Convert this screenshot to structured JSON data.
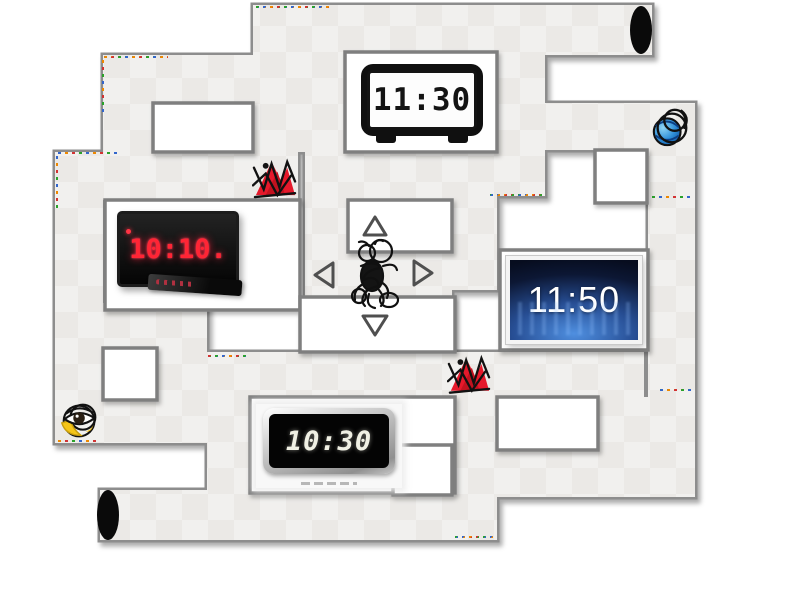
{
  "maze": {
    "wall_color": "#8d8d8d",
    "path_color": "#f1f0ee",
    "path_alt_color": "#ebe9e6",
    "room_color": "#ffffff",
    "tunnel_color": "#0a0a0a",
    "tunnels": [
      "top-right-opening",
      "bottom-left-opening"
    ]
  },
  "clocks": {
    "alarm": {
      "time": "11:30",
      "kind": "black digital alarm clock",
      "digit_color": "#141414",
      "face_color": "#fdfdfd"
    },
    "led": {
      "time": "10:10.",
      "kind": "red LED wall clock with remote",
      "digit_color": "#ff2535",
      "face_color": "#0a0a0a"
    },
    "screen": {
      "time": "11:50",
      "kind": "glowing blue screen clock",
      "digit_color": "#ffffff",
      "face_color": "#16305e"
    },
    "wall": {
      "time": "10:30",
      "kind": "silver framed digital wall clock",
      "digit_color": "#f0f0e4",
      "face_color": "#040404"
    }
  },
  "controls": {
    "up": "up-arrow",
    "down": "down-arrow",
    "left": "left-arrow",
    "right": "right-arrow",
    "arrow_color": "#4f4f4f"
  },
  "sprites": {
    "player": "fly-scribble",
    "hazard_1": "red-spider-scribble",
    "hazard_2": "red-spider-scribble",
    "marker_ball": "blue-ball-scribble",
    "marker_eye": "eye-scribble",
    "spider_color": "#e5192b",
    "ball_color": "#2f8fd8",
    "eye_color": "#f5c518"
  }
}
